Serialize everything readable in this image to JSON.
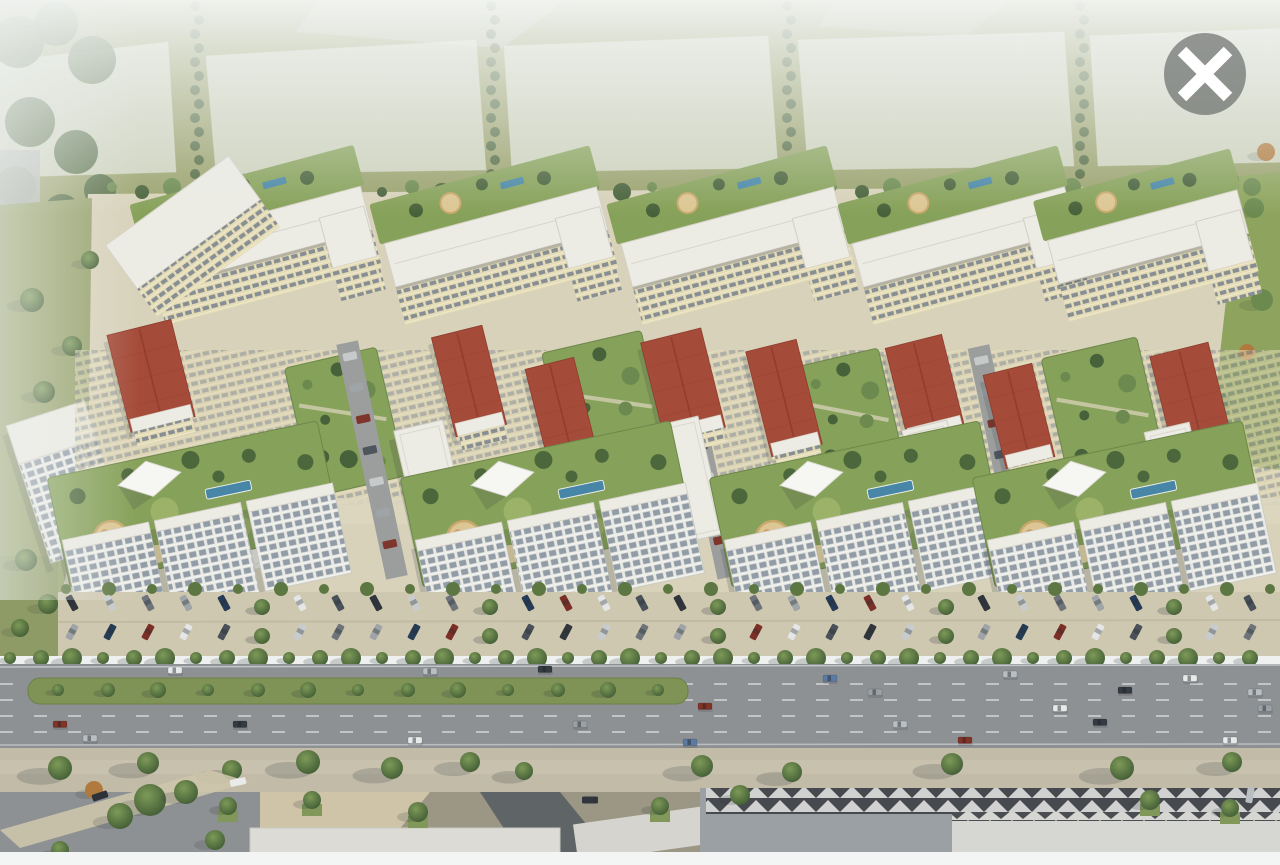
{
  "meta": {
    "alt": "Aerial 3D rendering of a large residential complex with courtyards, red and white roofs, parking rows and a wide highway in front"
  },
  "viewer": {
    "icons": {
      "close": "x-in-circle"
    }
  },
  "colors": {
    "haze": "#eef1ef",
    "topGrass": "#9aa26d",
    "ghost": "#edf0ef",
    "ghostGray": "#b4b7b3",
    "ground": "#d8d2ba",
    "groundLight": "#ddd6c0",
    "courtyard": "#86a159",
    "lawn": "#9db269",
    "treeDark": "#47613a",
    "treeMid": "#6c8a50",
    "treeOrange": "#b07a3e",
    "playground": "#dcc693",
    "playgroundEdge": "#c8a86b",
    "pool": "#4786a6",
    "roofWhite": "#ecebe4",
    "roofEdge": "#d3d0c6",
    "cream": "#e3dab6",
    "windowDark": "#78828e",
    "facadeWhite": "#e9eae5",
    "windowGrid": "#929ca6",
    "redRoof": "#a54b39",
    "redRoofDark": "#8e3c2d",
    "innerRoad": "#9b9e9c",
    "parkingPave": "#cfc8b0",
    "hedge": "#5d7742",
    "asphalt": "#8e9193",
    "laneLine": "#d9dbdd",
    "median": "#7e9355",
    "sidewalk": "#c1bba8",
    "plaza": "#cfc4a7",
    "shadow": "rgba(50,56,62,0.38)",
    "roofDark": "#46494d",
    "roofLight": "#d6d6d2",
    "fgGray": "#9aa0a3",
    "bottomBar": "#f3f5f5",
    "closeCircle": "rgba(72,76,77,0.55)",
    "closeX": "#ffffff",
    "carColors": [
      "#30363c",
      "#c9ccce",
      "#6e747a",
      "#9fa4a8",
      "#263b55",
      "#7b2f26",
      "#e4e6e6",
      "#4a5158"
    ],
    "roadCarColors": [
      "#e8eaea",
      "#b9bec2",
      "#343b42",
      "#5b7ba3",
      "#9aa0a5",
      "#823326"
    ]
  },
  "scene": {
    "upper_modules": [
      {
        "cx": 262,
        "w": 224
      },
      {
        "cx": 500,
        "w": 220
      },
      {
        "cx": 737,
        "w": 220
      },
      {
        "cx": 968,
        "w": 220
      },
      {
        "cx": 1152,
        "w": 196
      }
    ],
    "left_slab": {
      "x": 122,
      "y": 192,
      "w": 152,
      "h": 54
    },
    "left_tower": {
      "x": 26,
      "y": 410,
      "w": 82,
      "h": 144
    },
    "gardens": [
      [
        298,
        356,
        94,
        132
      ],
      [
        556,
        340,
        102,
        140
      ],
      [
        808,
        356,
        86,
        132
      ],
      [
        1056,
        346,
        98,
        144
      ]
    ],
    "red_blocks": [
      [
        118,
        326,
        66,
        100
      ],
      [
        443,
        330,
        52,
        102
      ],
      [
        536,
        362,
        50,
        96
      ],
      [
        652,
        334,
        62,
        102
      ],
      [
        758,
        344,
        52,
        108
      ],
      [
        896,
        340,
        58,
        96
      ],
      [
        994,
        368,
        50,
        96
      ],
      [
        1161,
        348,
        60,
        100
      ]
    ],
    "white_slabs": [
      [
        228,
        454,
        52,
        114
      ],
      [
        406,
        424,
        50,
        114
      ],
      [
        664,
        420,
        48,
        120
      ],
      [
        914,
        424,
        46,
        112
      ],
      [
        1156,
        426,
        46,
        110
      ]
    ],
    "podiums": [
      {
        "cx": 196
      },
      {
        "cx": 549
      },
      {
        "cx": 858
      },
      {
        "cx": 1121
      }
    ],
    "streets": [
      [
        372,
        340,
        240
      ],
      [
        703,
        336,
        244
      ],
      [
        1003,
        344,
        236
      ]
    ],
    "parking": {
      "x0": 72,
      "count": 32,
      "step": 38,
      "rows": [
        {
          "y": 603,
          "rot": 62
        },
        {
          "y": 632,
          "rot": 118
        }
      ]
    },
    "hedge": {
      "y": 589,
      "count": 29,
      "step": 43,
      "x0": 66
    },
    "treeline": {
      "y": 658,
      "count": 41,
      "step": 31,
      "x0": 10
    },
    "median": {
      "x": 28,
      "y": 678,
      "w": 660,
      "h": 26,
      "trees": 13,
      "tx0": 58,
      "tstep": 50,
      "ty": 690
    },
    "lane_dashes": [
      684,
      700,
      716,
      732
    ],
    "road_cars": [
      [
        175,
        670,
        0
      ],
      [
        430,
        671,
        1
      ],
      [
        545,
        669,
        2
      ],
      [
        830,
        678,
        3
      ],
      [
        1010,
        674,
        1
      ],
      [
        1190,
        678,
        0
      ],
      [
        875,
        692,
        4
      ],
      [
        1125,
        690,
        2
      ],
      [
        1255,
        692,
        1
      ],
      [
        705,
        706,
        5
      ],
      [
        1060,
        708,
        0
      ],
      [
        90,
        738,
        1
      ],
      [
        240,
        724,
        2
      ],
      [
        415,
        740,
        0
      ],
      [
        580,
        724,
        4
      ],
      [
        690,
        742,
        3
      ],
      [
        900,
        724,
        1
      ],
      [
        965,
        740,
        5
      ],
      [
        1100,
        722,
        2
      ],
      [
        1230,
        740,
        0
      ],
      [
        60,
        724,
        5
      ],
      [
        1265,
        708,
        4
      ]
    ],
    "sidewalk_trees": [
      [
        60,
        768,
        12
      ],
      [
        148,
        763,
        11
      ],
      [
        232,
        770,
        10
      ],
      [
        308,
        762,
        12
      ],
      [
        392,
        768,
        11
      ],
      [
        470,
        762,
        10
      ],
      [
        524,
        771,
        9
      ],
      [
        702,
        766,
        11
      ],
      [
        792,
        772,
        10
      ],
      [
        952,
        764,
        11
      ],
      [
        1122,
        768,
        12
      ],
      [
        1232,
        762,
        10
      ]
    ],
    "plaza_trees": [
      [
        228,
        806
      ],
      [
        312,
        800
      ],
      [
        418,
        812
      ],
      [
        660,
        806
      ],
      [
        1150,
        800
      ],
      [
        1230,
        808
      ]
    ],
    "fg_trees": [
      [
        150,
        800,
        16
      ],
      [
        186,
        792,
        12
      ],
      [
        120,
        816,
        13
      ],
      [
        94,
        790,
        9
      ],
      [
        215,
        840,
        10
      ],
      [
        60,
        850,
        9
      ],
      [
        740,
        795,
        10
      ]
    ],
    "fg_cars": [
      [
        100,
        796,
        "#2c3238",
        -18
      ],
      [
        238,
        782,
        "#e9eaea",
        -12
      ],
      [
        590,
        800,
        "#30363c",
        0
      ],
      [
        1250,
        795,
        "#b9bec2",
        -80
      ]
    ],
    "top_tree_cols": [
      197,
      493,
      789,
      1082
    ],
    "boundary_trees": {
      "y": 187,
      "count": 39,
      "step": 30,
      "x0": 112
    },
    "field_trees": [
      [
        1254,
        208,
        10,
        0
      ],
      [
        1238,
        258,
        9,
        1
      ],
      [
        1262,
        300,
        11,
        0
      ],
      [
        1247,
        352,
        8,
        1
      ],
      [
        1231,
        180,
        8,
        0
      ],
      [
        1266,
        152,
        9,
        1
      ],
      [
        1222,
        402,
        9,
        0
      ]
    ],
    "left_blobs": [
      [
        18,
        42,
        26
      ],
      [
        56,
        24,
        22
      ],
      [
        92,
        60,
        24
      ],
      [
        30,
        122,
        25
      ],
      [
        76,
        152,
        22
      ],
      [
        16,
        186,
        20
      ],
      [
        62,
        212,
        18
      ],
      [
        100,
        190,
        16
      ]
    ],
    "left_grass_trees": [
      [
        32,
        300,
        12
      ],
      [
        72,
        346,
        10
      ],
      [
        44,
        392,
        11
      ],
      [
        90,
        260,
        9
      ],
      [
        26,
        560,
        11
      ],
      [
        48,
        604,
        10
      ],
      [
        20,
        628,
        9
      ]
    ],
    "close_button": {
      "cx": 1205,
      "cy": 74,
      "r": 41
    }
  }
}
